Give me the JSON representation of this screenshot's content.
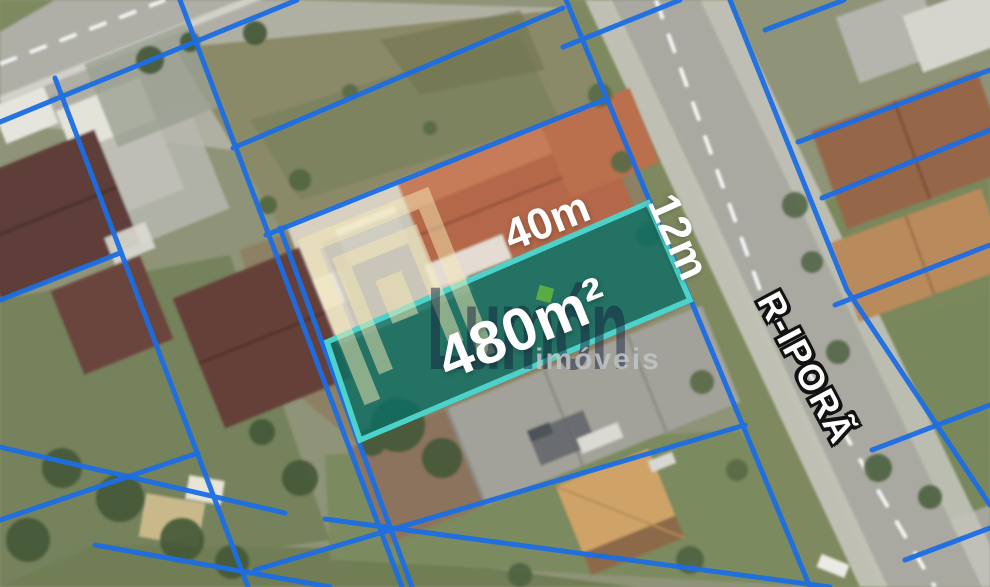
{
  "lot": {
    "area": "480m²",
    "frontage": "40m",
    "depth": "12m"
  },
  "street": {
    "name": "R-IPORÃ"
  },
  "watermark": {
    "brand": "Lumón",
    "subtitle": "imóveis"
  },
  "colors": {
    "boundary_blue": "#1c6ee4",
    "lot_fill": "#0e6e64",
    "lot_border": "#4cd2ca",
    "label_white": "#ffffff",
    "road_gray": "#a9a9a1",
    "watermark_navy": "#172140",
    "watermark_gold": "#f0d892",
    "accent_green": "#60b042"
  }
}
